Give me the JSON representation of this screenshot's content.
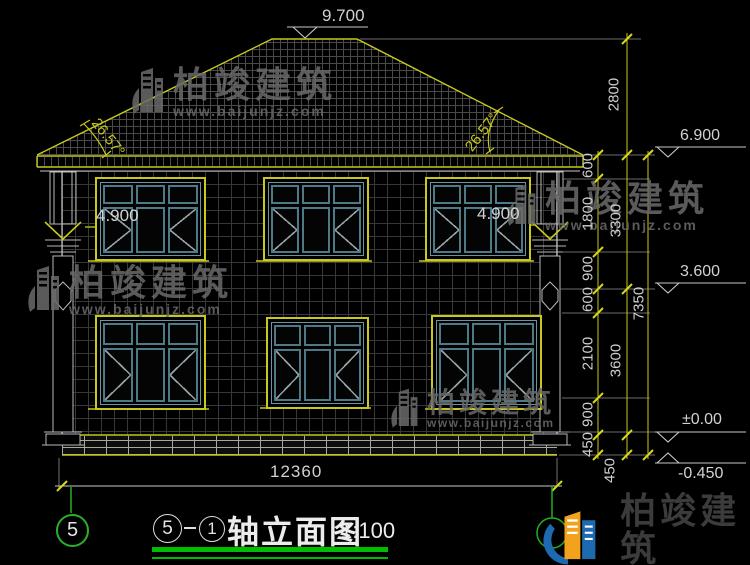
{
  "title_block": {
    "axis_from": "5",
    "axis_to": "1",
    "name": "轴立面图",
    "scale": "1:100"
  },
  "axis": {
    "left_bubble": "5"
  },
  "levels": {
    "ridge": "9.700",
    "eave": "6.900",
    "floor2": "3.600",
    "ground": "±0.00",
    "base": "-0.450",
    "window_left": "4.900",
    "window_right": "4.900"
  },
  "angles": {
    "left": "26.57°",
    "right": "26.57°"
  },
  "dims": {
    "roof_height": "2800",
    "overall_height": "7350",
    "total_width": "12360",
    "storeys": [
      "3300",
      "3600",
      "450"
    ],
    "inner": [
      "600",
      "1800",
      "900",
      "600",
      "2100",
      "900",
      "450"
    ]
  },
  "watermark": {
    "brand": "柏竣建筑",
    "url": "www.baijunjz.com"
  },
  "logo": {
    "brand": "柏竣建筑",
    "url": "www.baijunjz.com"
  },
  "colors": {
    "cad_yellow": "#c8c81e",
    "cad_green": "#22b022",
    "mullion_teal": "#4e7a87",
    "logo_blue": "#1e6ab0",
    "logo_orange": "#f2a21c"
  }
}
